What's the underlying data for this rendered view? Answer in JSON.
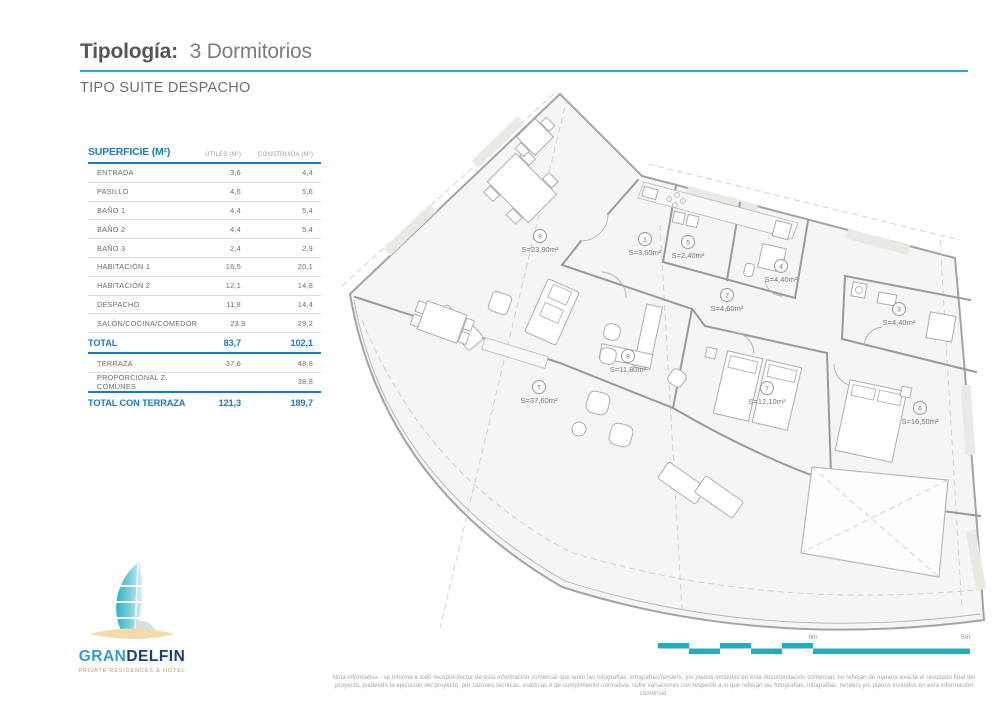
{
  "header": {
    "title_label": "Tipología:",
    "title_value": "3 Dormitorios",
    "subtitle": "TIPO SUITE DESPACHO"
  },
  "table": {
    "title": "SUPERFICIE (M²)",
    "col_utiles": "ÚTILES (M²)",
    "col_construida": "CONSTRUIDA (M²)",
    "rows": [
      {
        "label": "ENTRADA",
        "utiles": "3,6",
        "construida": "4,4"
      },
      {
        "label": "PASILLO",
        "utiles": "4,6",
        "construida": "5,6"
      },
      {
        "label": "BAÑO 1",
        "utiles": "4,4",
        "construida": "5,4"
      },
      {
        "label": "BAÑO 2",
        "utiles": "4,4",
        "construida": "5,4"
      },
      {
        "label": "BAÑO 3",
        "utiles": "2,4",
        "construida": "2,9"
      },
      {
        "label": "HABITACIÓN 1",
        "utiles": "16,5",
        "construida": "20,1"
      },
      {
        "label": "HABITACIÓN 2",
        "utiles": "12,1",
        "construida": "14,8"
      },
      {
        "label": "DESPACHO",
        "utiles": "11,8",
        "construida": "14,4"
      },
      {
        "label": "SALÓN/COCINA/COMEDOR",
        "utiles": "23,9",
        "construida": "29,2"
      }
    ],
    "total": {
      "label": "TOTAL",
      "utiles": "83,7",
      "construida": "102,1"
    },
    "extra_rows": [
      {
        "label": "TERRAZA",
        "utiles": "37,6",
        "construida": "48,8"
      },
      {
        "label": "PROPORCIONAL Z. COMUNES",
        "utiles": "",
        "construida": "38,8"
      }
    ],
    "grand_total": {
      "label": "TOTAL CON TERRAZA",
      "utiles": "121,3",
      "construida": "189,7"
    }
  },
  "plan": {
    "rooms": [
      {
        "num": "9",
        "area": "S=23,90m²"
      },
      {
        "num": "1",
        "area": "S=3,60m²"
      },
      {
        "num": "5",
        "area": "S=2,40m²"
      },
      {
        "num": "4",
        "area": "S=4,40m²"
      },
      {
        "num": "2",
        "area": "S=4,60m²"
      },
      {
        "num": "3",
        "area": "S=4,40m²"
      },
      {
        "num": "8",
        "area": "S=11,80m²"
      },
      {
        "num": "7",
        "area": "S=12,10m²"
      },
      {
        "num": "6",
        "area": "S=16,50m²"
      },
      {
        "num": "T",
        "area": "S=37,60m²"
      }
    ]
  },
  "logo": {
    "name_part1": "GRAN",
    "name_part2": "DELFIN",
    "tagline": "PRIVATE RESIDENCES & HOTEL"
  },
  "scalebar": {
    "zero_label": "0m",
    "five_label": "5m"
  },
  "footer": {
    "note": "Nota informativa - se informa a todo receptor/lector de esta información comercial que tanto las fotografías, infografías/renders, y/o planos incluidos en esta documentación comercial, no reflejan de manera exacta el resultado final del proyecto, pudiendo la ejecución del proyecto, por razones técnicas, estéticas o de cumplimiento normativa, sufrir variaciones con respecto a lo que reflejan las fotografías, infografías, renders y/o planos incluidos en esta información comercial."
  },
  "colors": {
    "teal_rule": "#27adcb",
    "table_blue": "#1a7bc0",
    "scalebar_teal": "#1bafc0",
    "logo_navy": "#1b3f72",
    "logo_gold": "#b6985f"
  }
}
